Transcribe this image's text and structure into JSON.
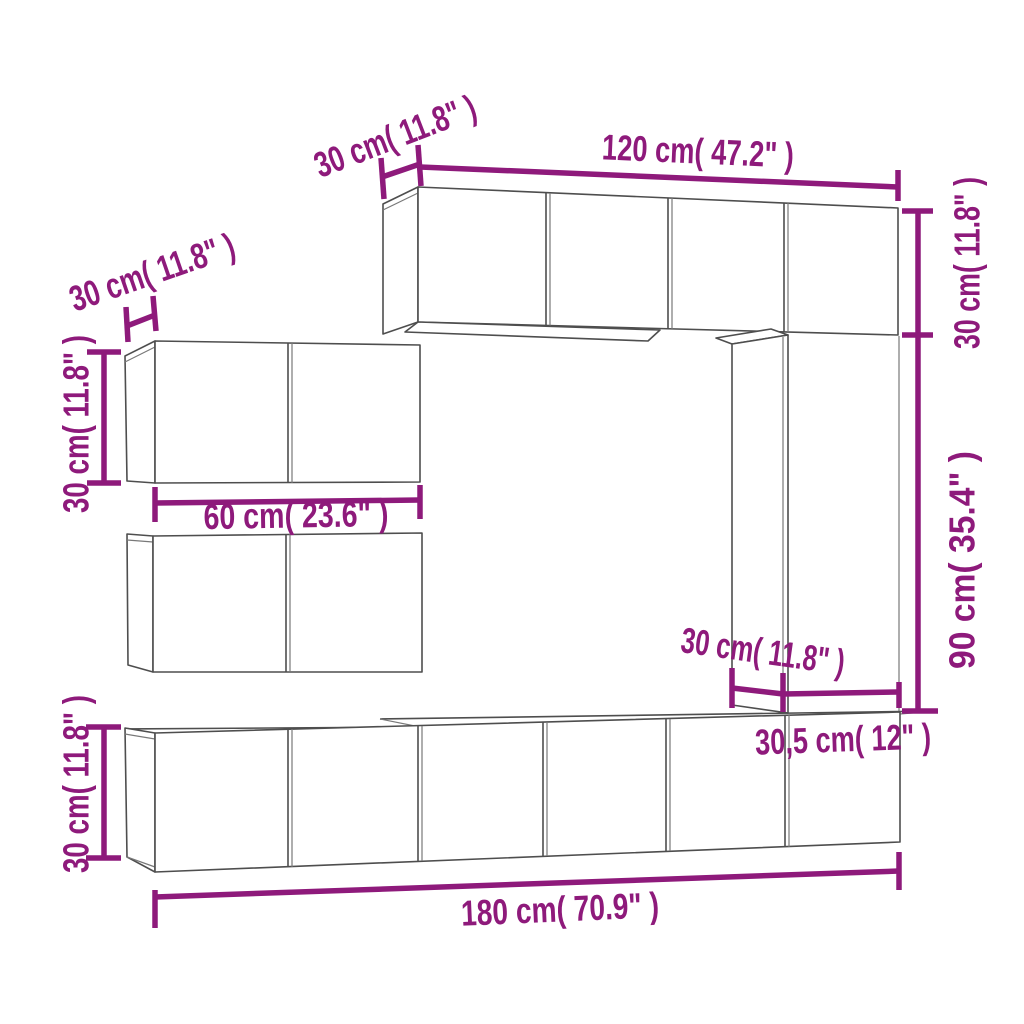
{
  "diagram": {
    "type": "furniture-dimension-diagram",
    "subject": "wall-mounted TV cabinet set",
    "colors": {
      "dimension": "#8E1A7B",
      "outline": "#4e4e4e",
      "background": "#ffffff"
    },
    "labels": {
      "top_depth": "30 cm( 11.8\" )",
      "top_width": "120 cm( 47.2\" )",
      "right_upper_height": "30 cm( 11.8\" )",
      "right_lower_height": "90 cm( 35.4\" )",
      "left_upper_depth": "30 cm( 11.8\" )",
      "left_upper_height": "30 cm( 11.8\" )",
      "left_width": "60 cm( 23.6\" )",
      "middle_depth": "30 cm( 11.8\" )",
      "bottom_right_depth": "30,5 cm( 12\" )",
      "bottom_left_height": "30 cm( 11.8\" )",
      "bottom_width": "180 cm( 70.9\" )"
    },
    "dimensions": [
      {
        "part": "top-cabinet-depth",
        "cm": 30,
        "inches": 11.8
      },
      {
        "part": "top-cabinet-width",
        "cm": 120,
        "inches": 47.2
      },
      {
        "part": "top-cabinet-height",
        "cm": 30,
        "inches": 11.8
      },
      {
        "part": "right-column-height",
        "cm": 90,
        "inches": 35.4
      },
      {
        "part": "left-cabinet-depth",
        "cm": 30,
        "inches": 11.8
      },
      {
        "part": "left-cabinet-height",
        "cm": 30,
        "inches": 11.8
      },
      {
        "part": "left-cabinet-width",
        "cm": 60,
        "inches": 23.6
      },
      {
        "part": "column-depth",
        "cm": 30,
        "inches": 11.8
      },
      {
        "part": "bottom-cabinet-depth",
        "cm": 30.5,
        "inches": 12
      },
      {
        "part": "bottom-cabinet-height",
        "cm": 30,
        "inches": 11.8
      },
      {
        "part": "bottom-row-width",
        "cm": 180,
        "inches": 70.9
      }
    ]
  }
}
